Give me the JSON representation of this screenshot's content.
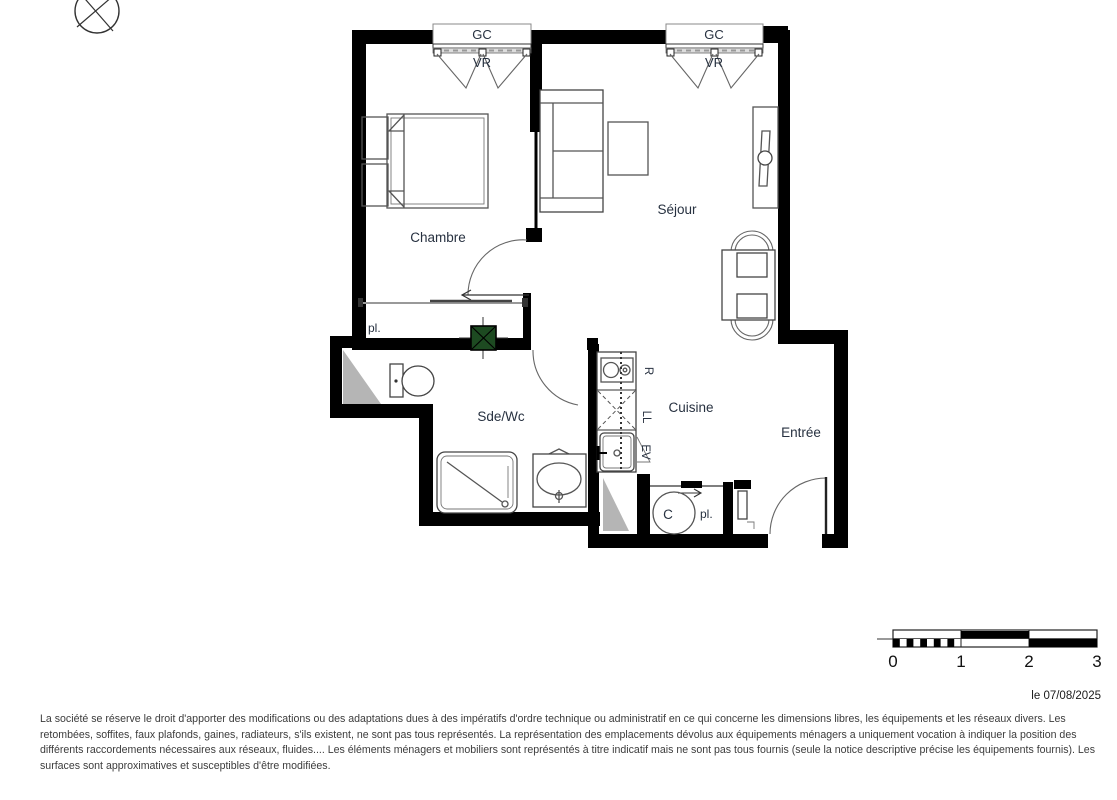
{
  "plan": {
    "rooms": {
      "chambre": "Chambre",
      "sejour": "Séjour",
      "sde_wc": "Sde/Wc",
      "cuisine": "Cuisine",
      "entree": "Entrée",
      "placard_hall": "pl.",
      "placard_entree": "pl.",
      "water_heater": "C"
    },
    "windows": {
      "window1": {
        "top_label": "GC",
        "bottom_label": "VR"
      },
      "window2": {
        "top_label": "GC",
        "bottom_label": "VR"
      }
    },
    "appliances": {
      "refrigerator": "R",
      "washing_machine": "LL",
      "sink": "EV"
    }
  },
  "scale_bar": {
    "labels": [
      "0",
      "1",
      "2",
      "3"
    ]
  },
  "footer": {
    "date": "le 07/08/2025",
    "disclaimer_lines": [
      "La société se réserve le droit d'apporter des modifications ou des adaptations dues à des impératifs d'ordre technique ou administratif en ce qui concerne les dimensions libres, les équipements et les réseaux divers. Les",
      "retombées, soffites, faux plafonds, gaines, radiateurs, s'ils existent, ne sont pas tous représentés. La représentation des emplacements dévolus aux équipements ménagers a uniquement vocation à indiquer la position des",
      "différents raccordements nécessaires aux réseaux, fluides.... Les éléments ménagers et mobiliers sont représentés à titre indicatif mais ne sont pas tous fournis (seule la notice descriptive précise les équipements fournis). Les",
      "surfaces sont approximatives et susceptibles d'être modifiées."
    ]
  },
  "colors": {
    "wall": "#000000",
    "duct_green": "#1d4a21",
    "shaft_gray": "#b5b5b5",
    "label": "#273140"
  }
}
